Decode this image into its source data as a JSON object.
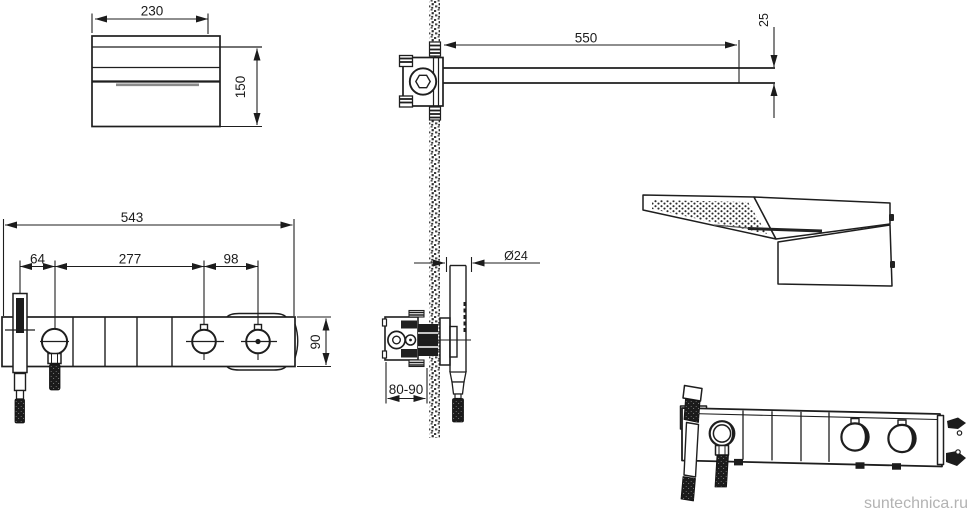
{
  "watermark": {
    "text": "suntechnica.ru",
    "color": "#b3b3b3"
  },
  "palette": {
    "line": "#1e1e1e",
    "thick_gray": "#8a8a8a",
    "dark_fill": "#1c1c1c",
    "background": "#ffffff"
  },
  "views": {
    "head_side": {
      "width": "230",
      "height": "150"
    },
    "arm_section": {
      "length": "550",
      "thickness": "25"
    },
    "panel_front": {
      "total_width": "543",
      "handshower_offset": "64",
      "knob_span": "277",
      "right_knob_offset": "98",
      "height": "90"
    },
    "valve_section": {
      "handle_diameter": "Ø24",
      "rough_in_depth": "80-90"
    }
  }
}
